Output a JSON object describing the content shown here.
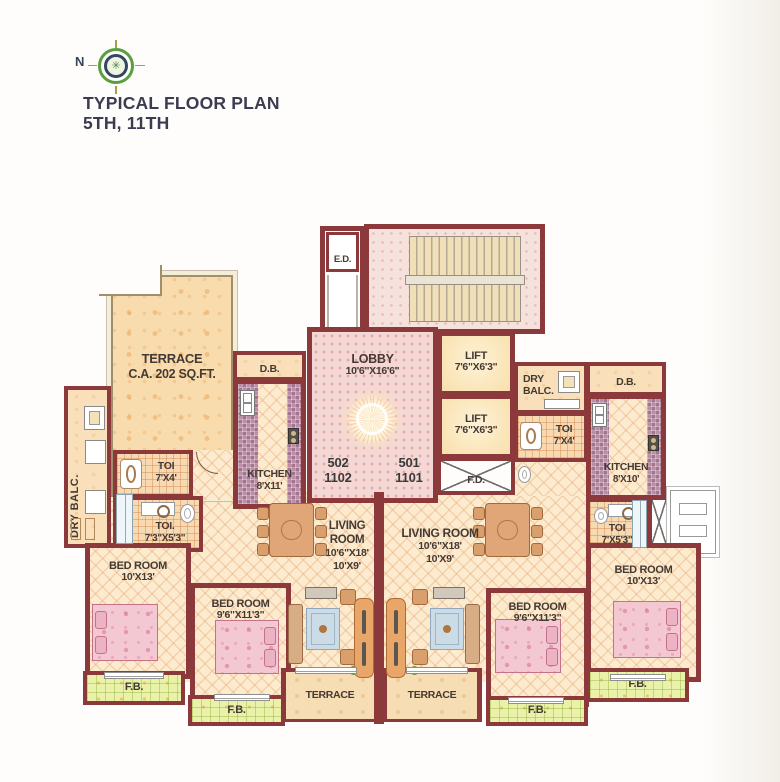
{
  "title": {
    "line1": "TYPICAL FLOOR PLAN",
    "line2": "5TH, 11TH"
  },
  "compass": {
    "n": "N"
  },
  "units": {
    "left": {
      "flat": "502",
      "floor_flat": "1102"
    },
    "right": {
      "flat": "501",
      "floor_flat": "1101"
    }
  },
  "rooms": {
    "ed": "E.D.",
    "fd": "F.D.",
    "db": "D.B.",
    "fb": "F.B.",
    "terrace_bottom": "TERRACE",
    "terrace_main": {
      "name": "TERRACE",
      "area": "C.A. 202 SQ.FT."
    },
    "lobby": {
      "name": "LOBBY",
      "dims": "10'6\"X16'6\""
    },
    "lift": {
      "name": "LIFT",
      "dims": "7'6\"X6'3\""
    },
    "dry_balc_left": "DRY BALC.",
    "dry_balc_right": {
      "line1": "DRY",
      "line2": "BALC."
    },
    "kitchen_left": {
      "name": "KITCHEN",
      "dims": "8'X11'"
    },
    "kitchen_right": {
      "name": "KITCHEN",
      "dims": "8'X10'"
    },
    "toi_7x4": {
      "name": "TOI",
      "dims": "7'X4'"
    },
    "toi_left_lower": {
      "name": "TOI.",
      "dims": "7'3\"X5'3\""
    },
    "toi_right_lower": {
      "name": "TOI",
      "dims": "7'X5'3\""
    },
    "living_left": {
      "line1": "LIVING",
      "line2": "ROOM",
      "dim1": "10'6\"X18'",
      "dim2": "10'X9'"
    },
    "living_right": {
      "name": "LIVING ROOM",
      "dim1": "10'6\"X18'",
      "dim2": "10'X9'"
    },
    "bed_10x13": {
      "name": "BED ROOM",
      "dims": "10'X13'"
    },
    "bed_96x113": {
      "name": "BED ROOM",
      "dims": "9'6\"X11'3\""
    }
  },
  "colors": {
    "wall": "#8c393c",
    "floor_tile_cream": "#fcebcf",
    "lobby_pink": "#f3d8d5",
    "terrace_peach": "#f8dcae",
    "flower_bed_green": "#eaf2a9",
    "mosaic_purple": "#b98ea6",
    "bed_pink": "#f3c8d3",
    "label_ink": "#443933"
  }
}
